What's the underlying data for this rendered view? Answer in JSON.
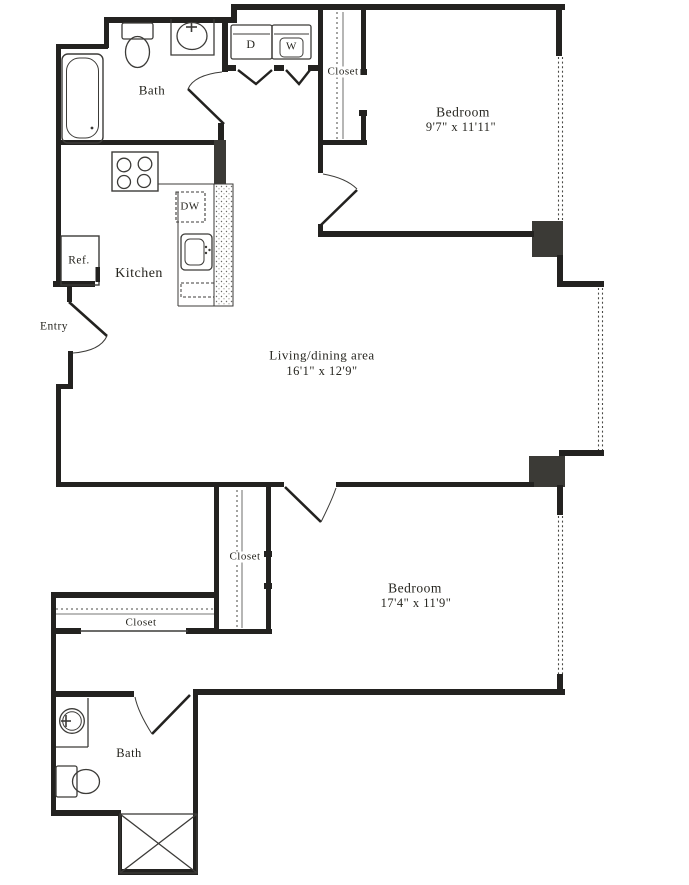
{
  "title": "Two bedroom, two bath apartment floor plan",
  "colors": {
    "wall": "#232220",
    "line": "#3c3b38",
    "window": "#4a4a46",
    "background": "#ffffff",
    "text": "#26251f"
  },
  "rooms": {
    "bath_top": {
      "label": "Bath"
    },
    "closet_top": {
      "label": "Closet"
    },
    "bedroom_top": {
      "label": "Bedroom",
      "dimensions": "9'7\" x 11'11\""
    },
    "kitchen": {
      "label": "Kitchen"
    },
    "entry": {
      "label": "Entry"
    },
    "living": {
      "label": "Living/dining area",
      "dimensions": "16'1\" x 12'9\""
    },
    "closet_mid": {
      "label": "Closet"
    },
    "closet_bottom": {
      "label": "Closet"
    },
    "bedroom_bottom": {
      "label": "Bedroom",
      "dimensions": "17'4\" x 11'9\""
    },
    "bath_bottom": {
      "label": "Bath"
    }
  },
  "appliances": {
    "dryer": "D",
    "washer": "W",
    "dishwasher": "DW",
    "refrigerator": "Ref."
  }
}
